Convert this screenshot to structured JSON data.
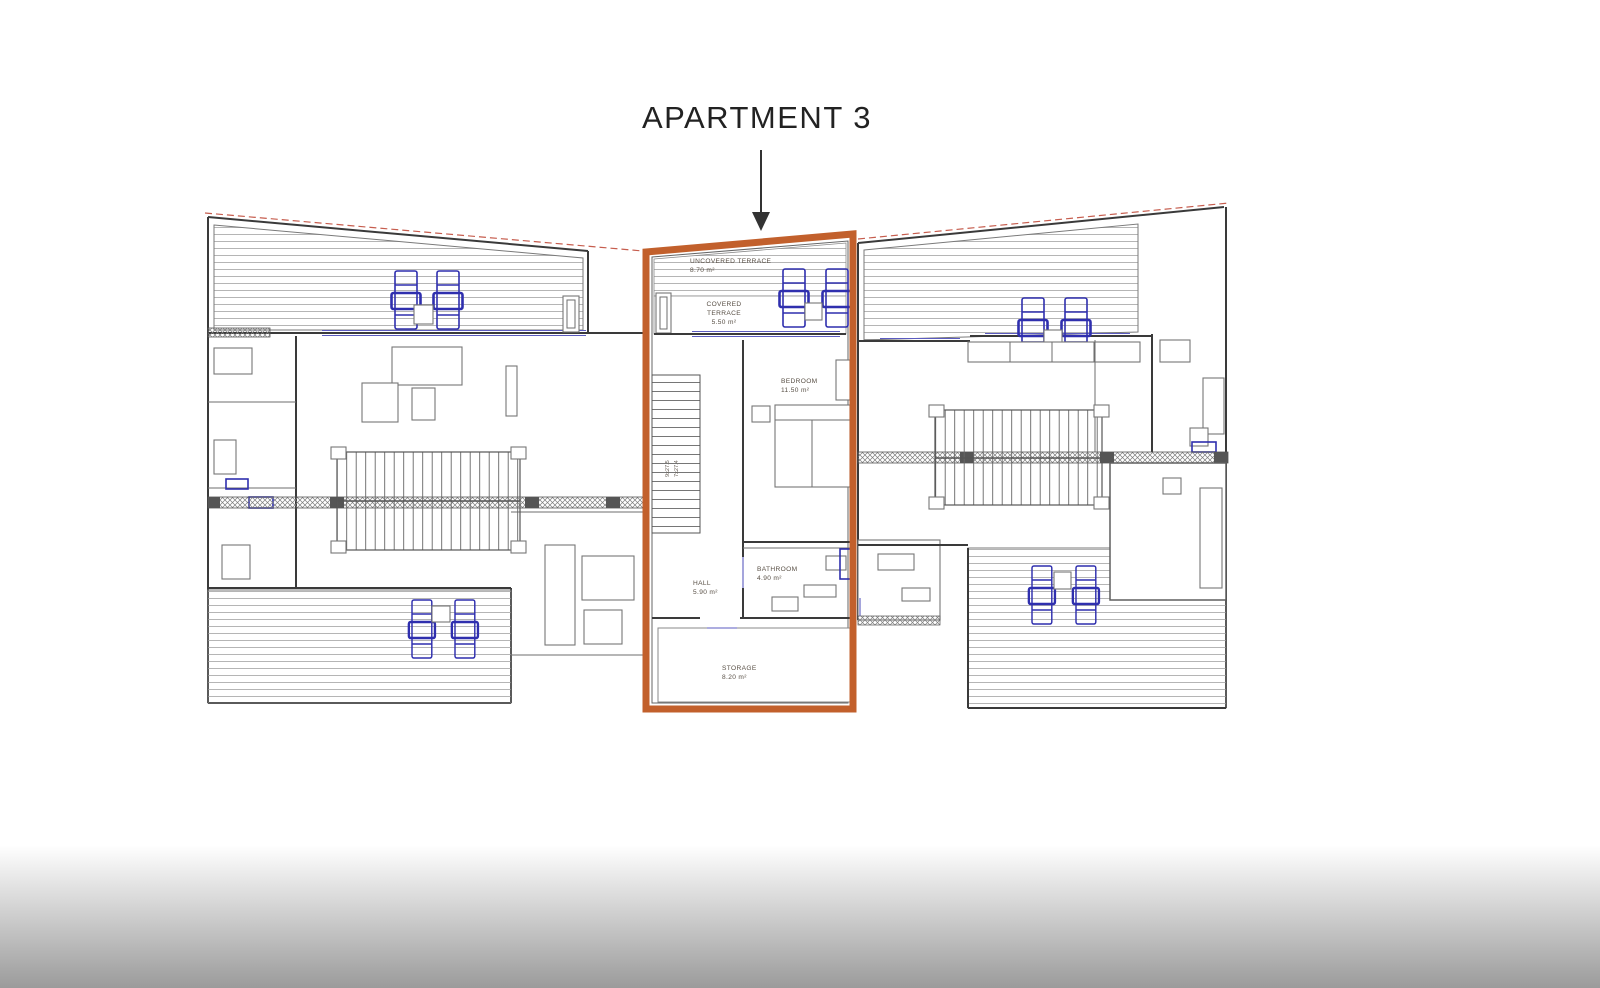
{
  "title": "APARTMENT 3",
  "colors": {
    "highlight_orange": "#c2602c",
    "furniture_blue": "#2f2fae",
    "roof_line_red": "#c65d4e",
    "wall_gray": "#3a3a3a",
    "bottom_gradient_gray": "#9b9b9b"
  },
  "apartment3": {
    "rooms": [
      {
        "name": "UNCOVERED TERRACE",
        "area": "8.70 m²"
      },
      {
        "name": "COVERED",
        "name_line2": "TERRACE",
        "area": "5.50 m²"
      },
      {
        "name": "BEDROOM",
        "area": "11.50 m²"
      },
      {
        "name": "HALL",
        "area": "5.90 m²"
      },
      {
        "name": "BATHROOM",
        "area": "4.90 m²"
      },
      {
        "name": "STORAGE",
        "area": "8.20 m²"
      }
    ],
    "stair_note_line1": "9x27.5",
    "stair_note_line2": "7x27.4"
  }
}
